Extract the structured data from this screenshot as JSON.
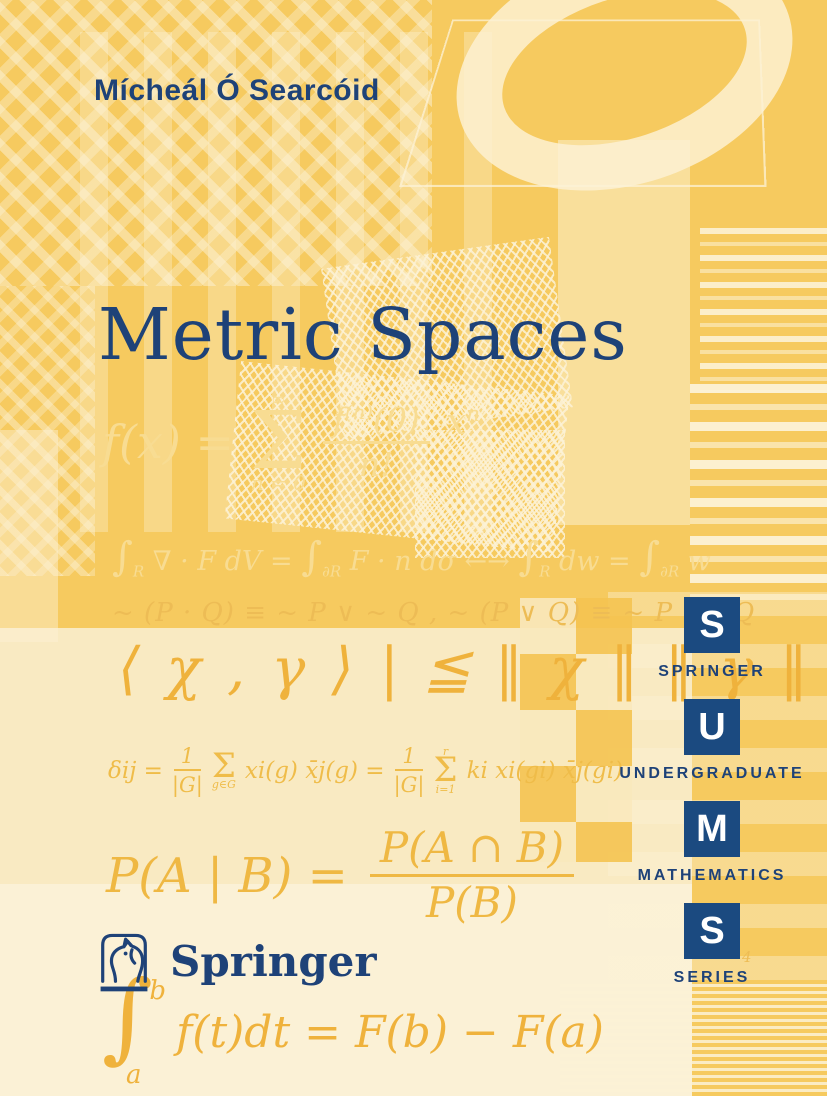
{
  "palette": {
    "navy": "#1E4278",
    "square_blue": "#1B4A80",
    "gold": "#F6CA5F",
    "pale_gold": "#F9DF9B",
    "cream": "#FCF2D6",
    "parchment": "#F9EAC2",
    "parchment_light": "#FBF1D6",
    "formula_light": "#F8DC92",
    "formula_mid": "#EDBC55",
    "formula_strong": "#EFB23C",
    "formula_warm": "#EFBC49",
    "formula_deep": "#EFB843",
    "white": "#FFFFFF"
  },
  "cover": {
    "author": "Mícheál Ó Searcóid",
    "title": "Metric Spaces"
  },
  "formulas": {
    "taylor": {
      "lhs": "f(x) =",
      "sum_sup": "∞",
      "sum": "Σ",
      "sum_sub": "n = 0",
      "num_base": "f",
      "num_sup": "(n)",
      "num_arg": "(0)",
      "den": "n!",
      "rhs_base": "x",
      "rhs_sup": "n"
    },
    "divergence": {
      "int": "∫",
      "sub_r": "R",
      "sub_dr": "∂R",
      "seg1": " ∇ · F dV = ",
      "seg2": " F · n dσ ",
      "arrow": " ←→ ",
      "seg3": " dw = ",
      "seg4": " w"
    },
    "demorgan": {
      "text": "~ (P · Q) ≡ ~ P ∨ ~ Q ,  ~ (P ∨ Q) ≡ ~ P · ~ Q"
    },
    "cauchy_schwarz": {
      "lhs": "⟨ χ , γ ⟩ |",
      "rel": "≦",
      "rhs": "‖ χ ‖ ‖ γ ‖"
    },
    "orthogonality": {
      "lhs": "δij =",
      "num1": "1",
      "den1": "|G|",
      "sum": "Σ",
      "sum1_sub": "g∈G",
      "mid": "xi(g) x̄j(g) =",
      "num2": "1",
      "den2": "|G|",
      "sum2_sup": "r",
      "sum2_sub": "i=1",
      "tail": "ki xi(gi) x̄j(gi)"
    },
    "conditional_probability": {
      "lhs": "P(A | B) =",
      "num": "P(A ∩ B)",
      "den": "P(B)"
    },
    "ftc": {
      "sup": "b",
      "int": "∫",
      "sub": "a",
      "body": "f(t)dt = F(b) − F(a)"
    }
  },
  "series_sidebar": {
    "items": [
      {
        "letter": "S",
        "word": "SPRINGER"
      },
      {
        "letter": "U",
        "word": "UNDERGRADUATE"
      },
      {
        "letter": "M",
        "word": "MATHEMATICS"
      },
      {
        "letter": "S",
        "word": "SERIES"
      }
    ]
  },
  "publisher": {
    "name": "Springer"
  },
  "misc": {
    "exponent": "4"
  }
}
